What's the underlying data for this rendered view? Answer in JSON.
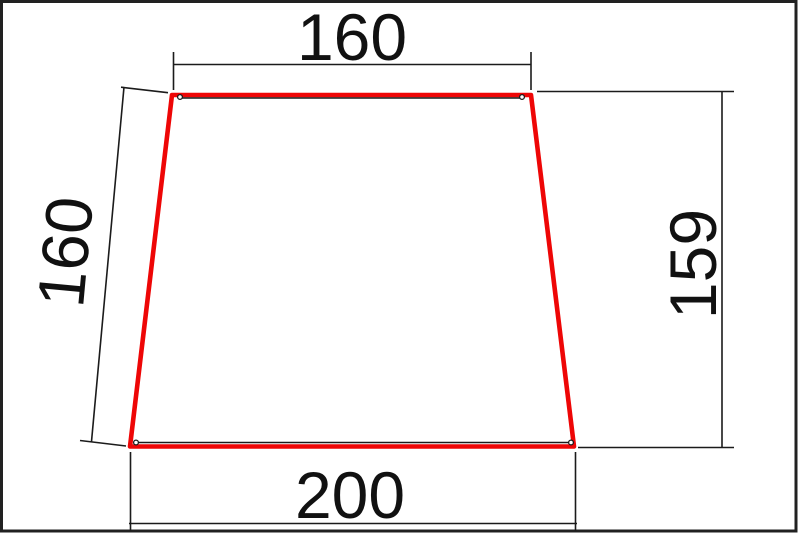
{
  "drawing": {
    "type": "technical-dimension-drawing",
    "shape": "trapezoid",
    "outline_color": "#ee0606",
    "line_color": "#1b1b1b",
    "dimensions": {
      "top_width": "160",
      "left_side": "160",
      "right_height": "159",
      "bottom_width": "200"
    }
  }
}
